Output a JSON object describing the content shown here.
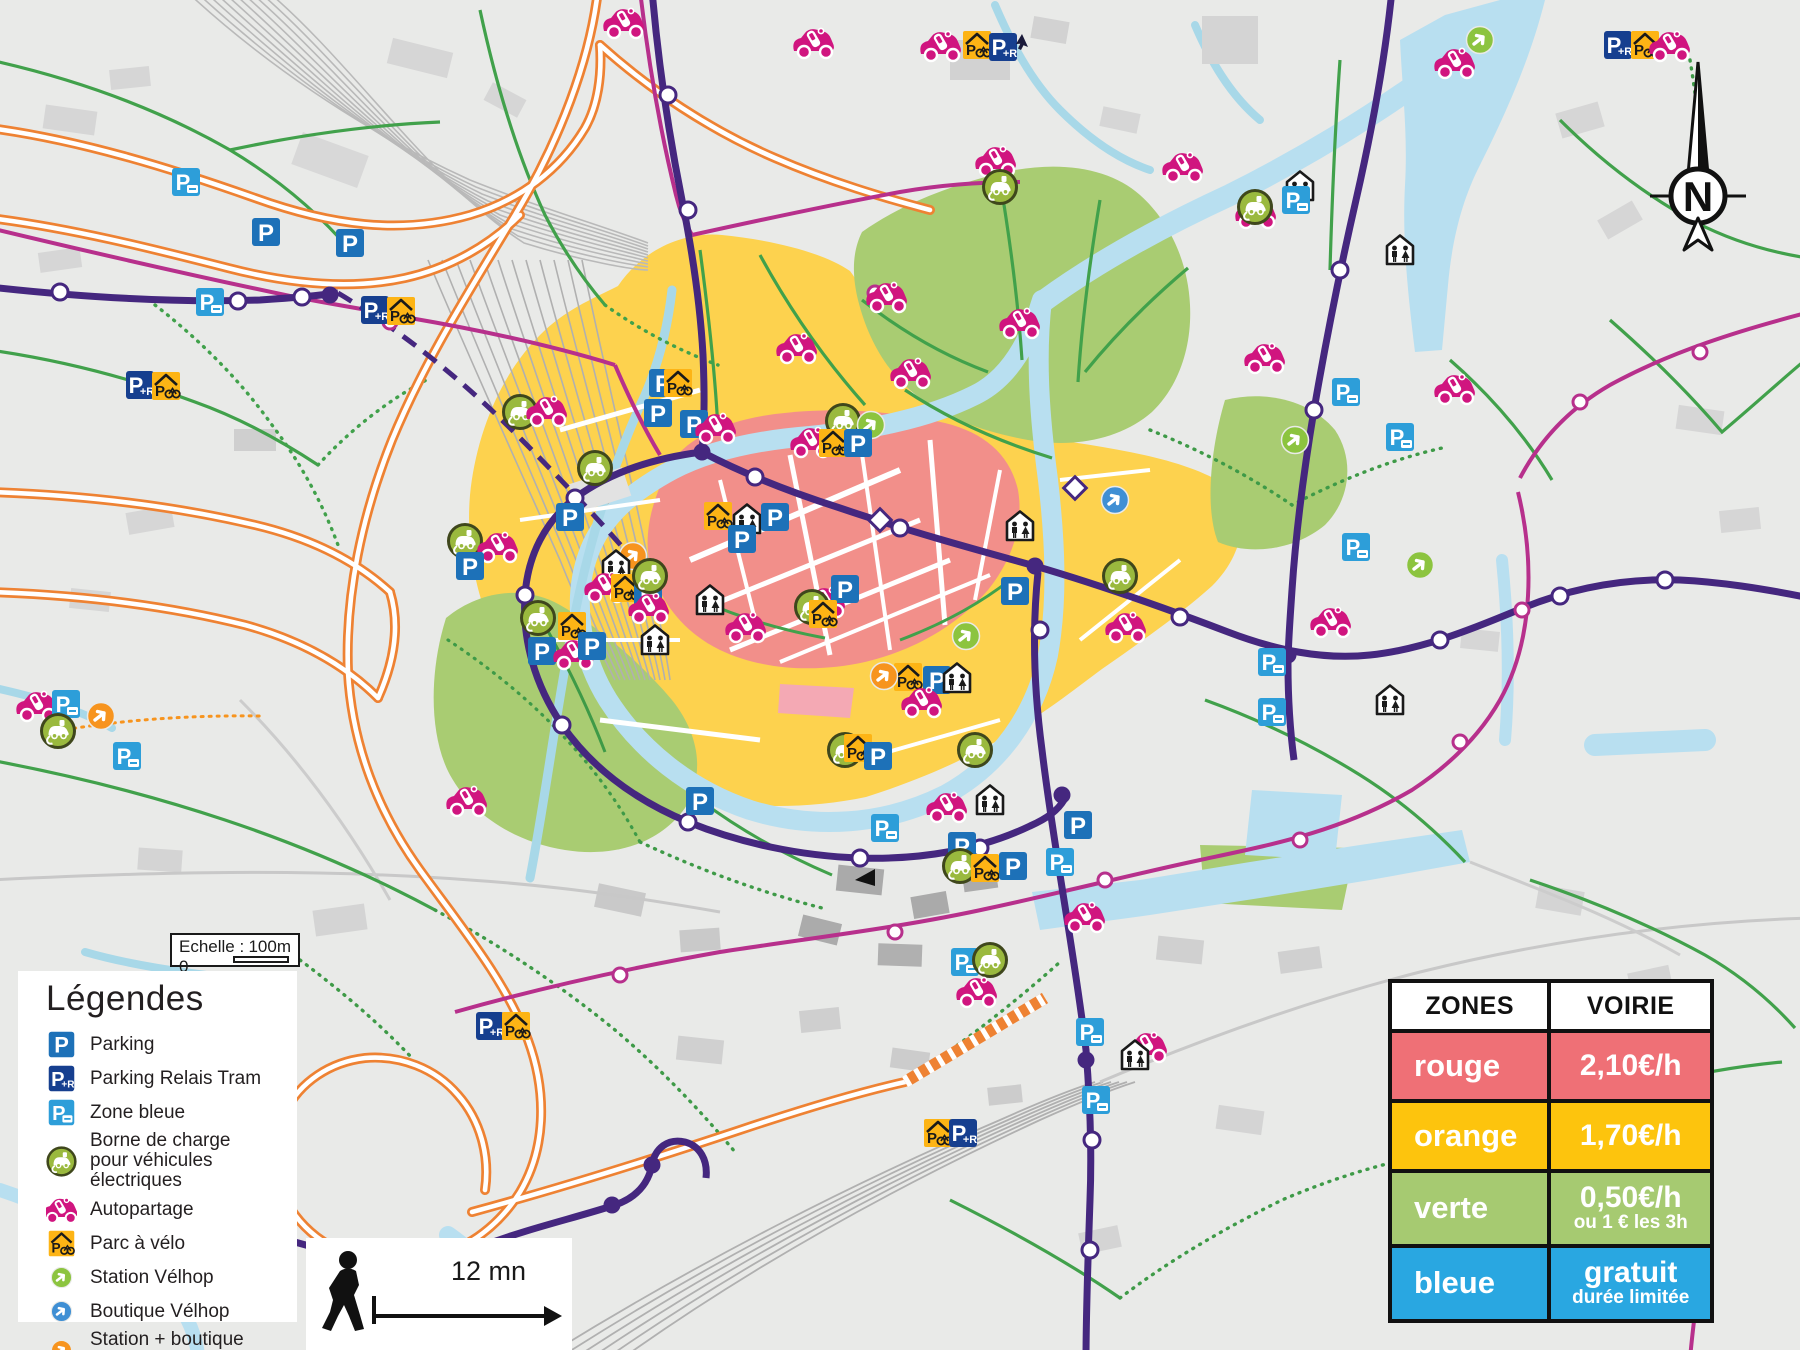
{
  "legend": {
    "title": "Légendes",
    "items": [
      {
        "icon": "p",
        "label": "Parking"
      },
      {
        "icon": "pr",
        "label": "Parking Relais Tram"
      },
      {
        "icon": "zb",
        "label": "Zone bleue"
      },
      {
        "icon": "charge",
        "label": "Borne de charge",
        "label2": "pour véhicules électriques"
      },
      {
        "icon": "auto",
        "label": "Autopartage"
      },
      {
        "icon": "velo",
        "label": "Parc à vélo"
      },
      {
        "icon": "sv",
        "label": "Station Vélhop"
      },
      {
        "icon": "bv",
        "label": "Boutique Vélhop"
      },
      {
        "icon": "sbv",
        "label": "Station + boutique Vélhop"
      },
      {
        "icon": "wc",
        "label": "Toilettes publiques"
      }
    ]
  },
  "scale_box": {
    "label": "Echelle : 0",
    "unit": "100m"
  },
  "walk_scale": {
    "duration": "12 mn"
  },
  "compass": {
    "label": "N"
  },
  "pricing_table": {
    "headers": [
      "ZONES",
      "VOIRIE"
    ],
    "rows": [
      {
        "zone": "rouge",
        "price": "2,10€/h",
        "note": "",
        "zone_color": "#ef7076"
      },
      {
        "zone": "orange",
        "price": "1,70€/h",
        "note": "",
        "zone_color": "#fdc40d"
      },
      {
        "zone": "verte",
        "price": "0,50€/h",
        "note": "ou 1 € les 3h",
        "zone_color": "#a6ca71"
      },
      {
        "zone": "bleue",
        "price": "gratuit",
        "note": "durée limitée",
        "zone_color": "#29a7e1"
      }
    ]
  },
  "map": {
    "zone_colors": {
      "rouge": "#f28f8a",
      "orange": "#fdd24e",
      "verte": "#a9cc72",
      "eau": "#b8dff0"
    },
    "markers": [
      [
        "auto",
        625,
        22
      ],
      [
        "auto",
        815,
        42
      ],
      [
        "auto",
        942,
        45
      ],
      [
        "velo",
        977,
        45
      ],
      [
        "pr",
        1003,
        47
      ],
      [
        "cursor",
        1022,
        42
      ],
      [
        "pr",
        1618,
        45
      ],
      [
        "velo",
        1645,
        45
      ],
      [
        "auto",
        1671,
        45
      ],
      [
        "sv",
        1480,
        40
      ],
      [
        "auto",
        1456,
        62
      ],
      [
        "auto",
        997,
        160
      ],
      [
        "auto",
        1184,
        166
      ],
      [
        "auto",
        1257,
        212
      ],
      [
        "charge",
        1000,
        187
      ],
      [
        "charge",
        1255,
        207
      ],
      [
        "wc",
        1300,
        186
      ],
      [
        "wc",
        1400,
        250
      ],
      [
        "zb",
        1296,
        200
      ],
      [
        "zb",
        186,
        182
      ],
      [
        "p",
        266,
        232
      ],
      [
        "p",
        350,
        243
      ],
      [
        "zb",
        210,
        302
      ],
      [
        "pr",
        375,
        310
      ],
      [
        "velo",
        401,
        311
      ],
      [
        "pr",
        140,
        385
      ],
      [
        "velo",
        166,
        386
      ],
      [
        "auto",
        888,
        296
      ],
      [
        "auto",
        1021,
        322
      ],
      [
        "auto",
        798,
        347
      ],
      [
        "auto",
        912,
        372
      ],
      [
        "auto",
        1266,
        357
      ],
      [
        "auto",
        1456,
        388
      ],
      [
        "p",
        663,
        383
      ],
      [
        "velo",
        678,
        383
      ],
      [
        "p",
        658,
        413
      ],
      [
        "p",
        694,
        424
      ],
      [
        "auto",
        717,
        427
      ],
      [
        "charge",
        843,
        421
      ],
      [
        "sv",
        871,
        425
      ],
      [
        "auto",
        812,
        441
      ],
      [
        "velo",
        833,
        443
      ],
      [
        "p",
        858,
        443
      ],
      [
        "charge",
        520,
        412
      ],
      [
        "auto",
        548,
        410
      ],
      [
        "charge",
        595,
        468
      ],
      [
        "velo",
        572,
        626
      ],
      [
        "charge",
        538,
        618
      ],
      [
        "p",
        542,
        651
      ],
      [
        "auto",
        575,
        653
      ],
      [
        "sbv",
        633,
        556
      ],
      [
        "charge",
        465,
        541
      ],
      [
        "auto",
        499,
        546
      ],
      [
        "p",
        570,
        517
      ],
      [
        "p",
        470,
        566
      ],
      [
        "velo",
        718,
        516
      ],
      [
        "wc",
        747,
        519
      ],
      [
        "p",
        775,
        517
      ],
      [
        "p",
        742,
        539
      ],
      [
        "wc",
        616,
        565
      ],
      [
        "wc",
        710,
        600
      ],
      [
        "wc",
        655,
        640
      ],
      [
        "auto",
        606,
        586
      ],
      [
        "velo",
        625,
        588
      ],
      [
        "p",
        648,
        593
      ],
      [
        "auto",
        650,
        607
      ],
      [
        "charge",
        650,
        576
      ],
      [
        "auto",
        747,
        626
      ],
      [
        "auto",
        826,
        601
      ],
      [
        "charge",
        812,
        607
      ],
      [
        "p",
        845,
        589
      ],
      [
        "velo",
        823,
        614
      ],
      [
        "p",
        1015,
        591
      ],
      [
        "wc",
        1020,
        526
      ],
      [
        "bv",
        1115,
        500
      ],
      [
        "sv",
        1295,
        440
      ],
      [
        "zb",
        1346,
        392
      ],
      [
        "zb",
        1400,
        437
      ],
      [
        "charge",
        1120,
        576
      ],
      [
        "sv",
        1420,
        565
      ],
      [
        "zb",
        1356,
        547
      ],
      [
        "auto",
        1127,
        626
      ],
      [
        "auto",
        1332,
        621
      ],
      [
        "p",
        592,
        646
      ],
      [
        "charge",
        845,
        750
      ],
      [
        "velo",
        858,
        748
      ],
      [
        "velo",
        908,
        677
      ],
      [
        "p",
        937,
        680
      ],
      [
        "wc",
        957,
        678
      ],
      [
        "sbv",
        884,
        676
      ],
      [
        "sv",
        966,
        636
      ],
      [
        "charge",
        975,
        750
      ],
      [
        "auto",
        923,
        701
      ],
      [
        "p",
        878,
        756
      ],
      [
        "p",
        700,
        801
      ],
      [
        "wc",
        990,
        800
      ],
      [
        "auto",
        948,
        806
      ],
      [
        "zb",
        885,
        828
      ],
      [
        "p",
        962,
        846
      ],
      [
        "p",
        1078,
        825
      ],
      [
        "zb",
        1060,
        862
      ],
      [
        "charge",
        960,
        866
      ],
      [
        "velo",
        985,
        868
      ],
      [
        "p",
        1013,
        866
      ],
      [
        "auto",
        1086,
        916
      ],
      [
        "tri",
        866,
        878
      ],
      [
        "zb",
        1272,
        662
      ],
      [
        "zb",
        1272,
        712
      ],
      [
        "wc",
        1390,
        700
      ],
      [
        "auto",
        38,
        705
      ],
      [
        "zb",
        66,
        704
      ],
      [
        "sbv",
        101,
        716
      ],
      [
        "charge",
        58,
        731
      ],
      [
        "zb",
        127,
        756
      ],
      [
        "auto",
        468,
        800
      ],
      [
        "pr",
        490,
        1026
      ],
      [
        "velo",
        516,
        1026
      ],
      [
        "zb",
        965,
        962
      ],
      [
        "charge",
        990,
        960
      ],
      [
        "auto",
        978,
        991
      ],
      [
        "zb",
        1090,
        1032
      ],
      [
        "auto",
        1148,
        1046
      ],
      [
        "wc",
        1135,
        1055
      ],
      [
        "zb",
        1096,
        1100
      ],
      [
        "velo",
        938,
        1133
      ],
      [
        "pr",
        963,
        1133
      ]
    ]
  }
}
